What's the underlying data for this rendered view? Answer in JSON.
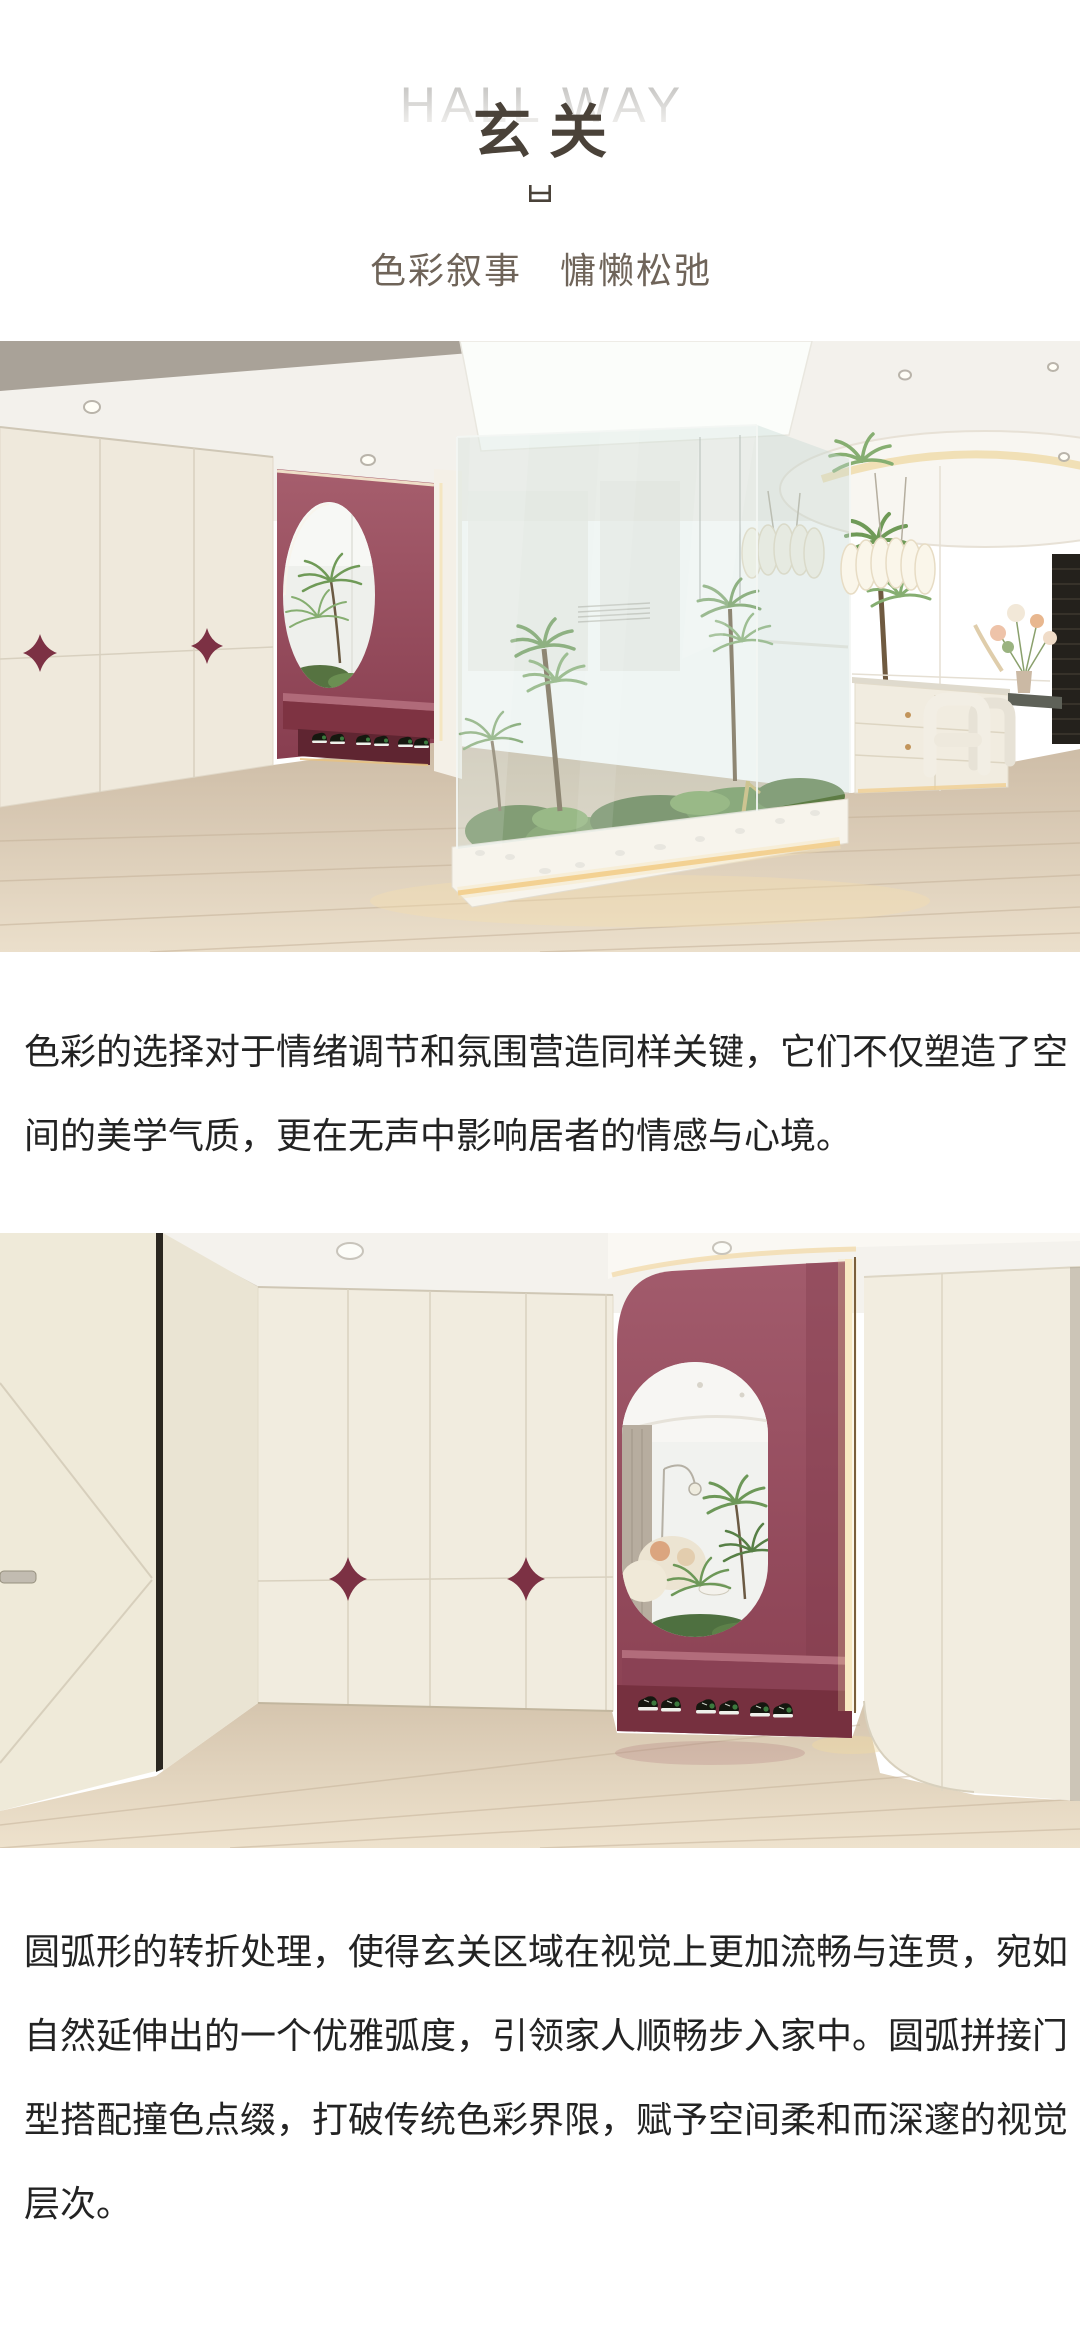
{
  "page": {
    "background": "#ffffff",
    "language": "zh-CN"
  },
  "header": {
    "title_en": "HALL WAY",
    "title_zh": "玄关",
    "divider_icon": "open-box-glyph",
    "subtitle": "色彩叙事　慵懒松弛"
  },
  "paragraphs": [
    "色彩的选择对于情绪调节和氛围营造同样关键，它们不仅塑造了空间的美学气质，更在无声中影响居者的情感与心境。",
    "圆弧形的转折处理，使得玄关区域在视觉上更加流畅与连贯，宛如自然延伸出的一个优雅弧度，引领家人顺畅步入家中。圆弧拼接门型搭配撞色点缀，打破传统色彩界限，赋予空间柔和而深邃的视觉层次。"
  ],
  "photos": [
    {
      "alt": "玄关全景：奶油色拼接柜门配酒红星形把手，红色壁龛内嵌椭圆镜与换鞋凳，中部玻璃景观中庭种植蕨类苔藓，右侧餐区有花艺边柜与白色餐椅",
      "accent_color": "#8c4154"
    },
    {
      "alt": "玄关近景：左侧入户门斜拼线条，奶油色柜体点缀酒红星形把手，红色圆弧壁龛配椭圆镜、换鞋凳与球鞋，右侧为圆弧转角柜体",
      "accent_color": "#8c4154"
    }
  ],
  "colors": {
    "accent_burgundy": "#8c4154",
    "star_handle": "#7c3144",
    "cabinet_cream": "#f0ebdf",
    "wood_floor": "#d8c8b2",
    "title_dark": "#4a4239",
    "subtitle_taupe": "#6f6459",
    "body_text": "#232323",
    "title_en_fade_top": "#c1c0be",
    "title_en_fade_bottom": "#f2f1ef",
    "led_warm": "#f2cf8e",
    "plant_green": "#6f9a57"
  }
}
